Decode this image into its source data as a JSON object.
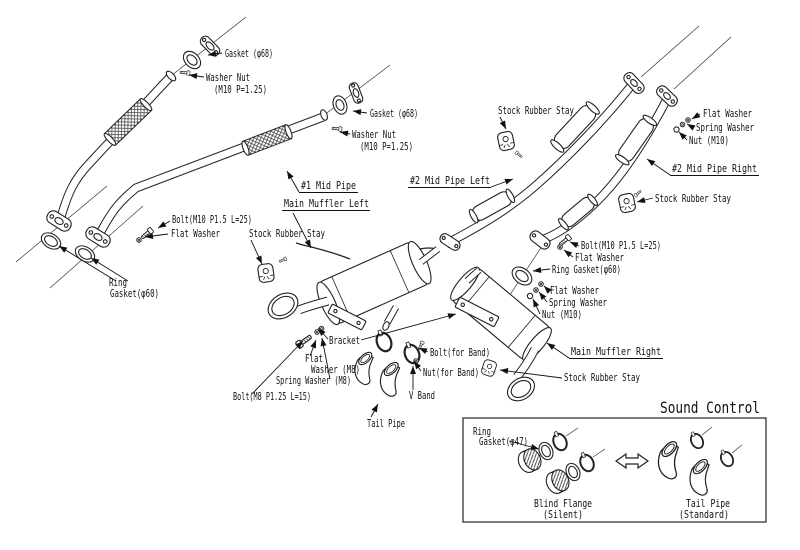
{
  "page": {
    "background": "#ffffff",
    "line_color": "#1a1a1a"
  },
  "components": {
    "mid_pipe_1": "#1 Mid Pipe",
    "main_muffler_left": "Main Muffler Left",
    "mid_pipe_2_left": "#2 Mid Pipe Left",
    "mid_pipe_2_right": "#2 Mid Pipe Right",
    "main_muffler_right": "Main Muffler Right"
  },
  "parts": {
    "gasket_68": "Gasket (φ68)",
    "washer_nut": "Washer Nut",
    "washer_nut_spec": "(M10 P=1.25)",
    "stock_rubber_stay": "Stock Rubber Stay",
    "flat_washer": "Flat Washer",
    "spring_washer": "Spring Washer",
    "nut_m10": "Nut (M10)",
    "bolt_m10": "Bolt(M10 P1.5 L=25)",
    "ring": "Ring",
    "gasket_60": "Gasket(φ60)",
    "ring_gasket_60": "Ring Gasket(φ60)",
    "bracket": "Bracket",
    "flat": "Flat",
    "washer_m8": "Washer (M8)",
    "spring_washer_m8": "Spring Washer (M8)",
    "bolt_m8": "Bolt(M8 P1.25 L=15)",
    "bolt_for_band": "Bolt(for Band)",
    "nut_for_band": "Nut(for Band)",
    "v_band": "V Band",
    "tail_pipe": "Tail Pipe"
  },
  "sound_control": {
    "title": "Sound Control",
    "ring": "Ring",
    "gasket_47": "Gasket(φ47)",
    "blind_flange": "Blind Flange",
    "blind_flange_variant": "(Silent)",
    "tail_pipe": "Tail Pipe",
    "tail_pipe_variant": "(Standard)"
  }
}
